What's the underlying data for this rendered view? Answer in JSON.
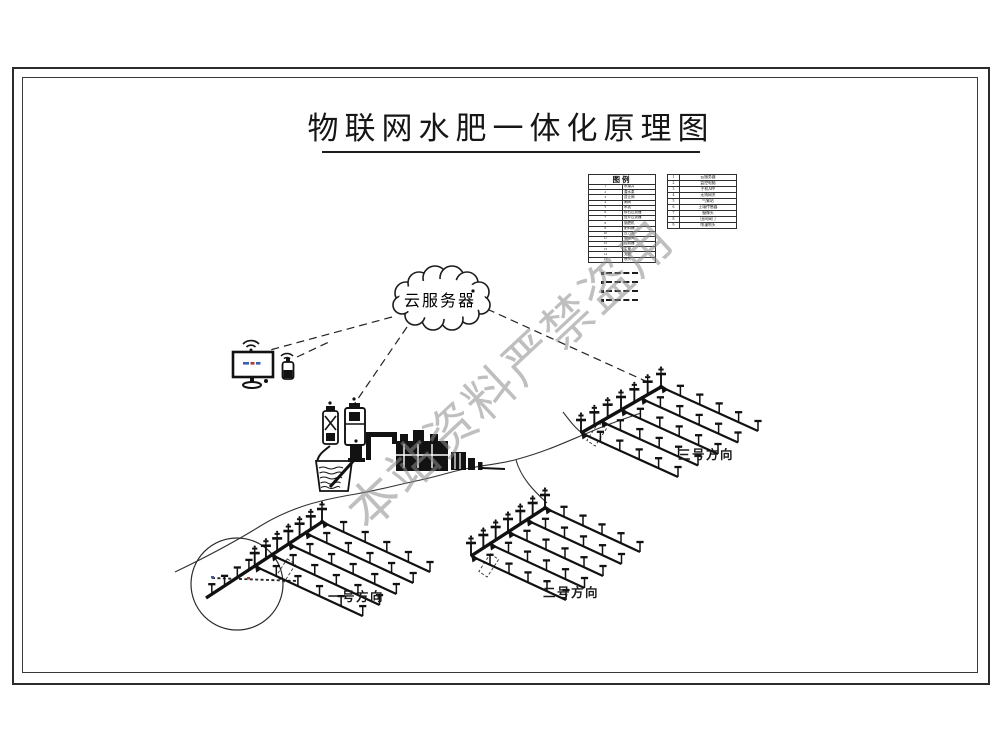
{
  "page": {
    "title": "物联网水肥一体化原理图",
    "watermark": "本站资料严禁盗用"
  },
  "cloud": {
    "label": "云服务器"
  },
  "legend": {
    "title": "图例",
    "left_rows": [
      {
        "no": "1",
        "label": "水源井"
      },
      {
        "no": "2",
        "label": "潜水泵"
      },
      {
        "no": "3",
        "label": "逆止阀"
      },
      {
        "no": "4",
        "label": "闸阀"
      },
      {
        "no": "5",
        "label": "水表"
      },
      {
        "no": "6",
        "label": "砂石过滤器"
      },
      {
        "no": "7",
        "label": "叠片过滤器"
      },
      {
        "no": "8",
        "label": "施肥机"
      },
      {
        "no": "9",
        "label": "肥料桶"
      },
      {
        "no": "10",
        "label": "压力表"
      },
      {
        "no": "11",
        "label": "电磁阀"
      },
      {
        "no": "12",
        "label": "控制器"
      },
      {
        "no": "13",
        "label": "主管"
      },
      {
        "no": "14",
        "label": "支管"
      },
      {
        "no": "15",
        "label": "喷头"
      }
    ],
    "right_rows": [
      {
        "no": "1",
        "label": "云服务器"
      },
      {
        "no": "2",
        "label": "监控电脑"
      },
      {
        "no": "3",
        "label": "手机APP"
      },
      {
        "no": "4",
        "label": "无线网关"
      },
      {
        "no": "5",
        "label": "气象站"
      },
      {
        "no": "6",
        "label": "土壤传感器"
      },
      {
        "no": "7",
        "label": "摄像头"
      },
      {
        "no": "8",
        "label": "田间阀门"
      },
      {
        "no": "9",
        "label": "喷灌喷头"
      }
    ],
    "line_samples": [
      {
        "pattern": "dashed"
      },
      {
        "pattern": "dashed"
      },
      {
        "pattern": "dashed"
      },
      {
        "pattern": "dashed"
      }
    ]
  },
  "fields": [
    {
      "label": "一号方向"
    },
    {
      "label": "二号方向"
    },
    {
      "label": "三号方向"
    }
  ]
}
